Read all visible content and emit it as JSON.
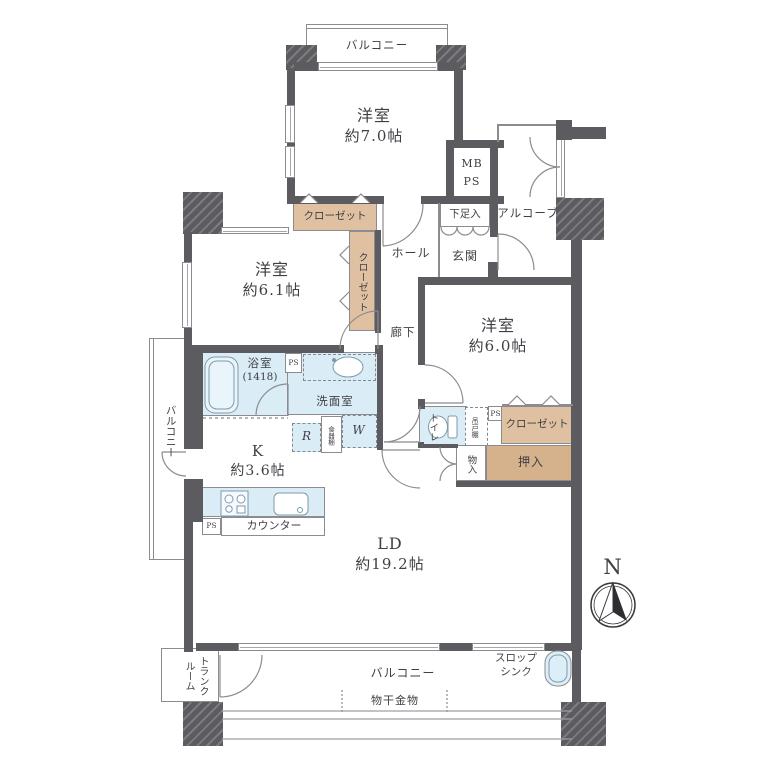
{
  "plan": {
    "rooms": {
      "bedroom_7": {
        "name": "洋室",
        "size": "約7.0帖"
      },
      "bedroom_61": {
        "name": "洋室",
        "size": "約6.1帖"
      },
      "bedroom_60": {
        "name": "洋室",
        "size": "約6.0帖"
      },
      "living_dining": {
        "name": "LD",
        "size": "約19.2帖"
      },
      "kitchen": {
        "name": "K",
        "size": "約3.6帖"
      },
      "bathroom": {
        "name": "浴室",
        "size": "(1418)"
      },
      "washroom": "洗面室",
      "toilet": "トイレ",
      "hall": "ホール",
      "corridor": "廊下",
      "entrance": "玄関",
      "alcove": "アルコーブ",
      "shoe_cabinet": "下足入"
    },
    "storage": {
      "closet": "クローゼット",
      "oshiire": "押入",
      "storage_small": "物入",
      "hanging_cupboard": "吊戸棚",
      "dish_shelf": "食器棚"
    },
    "outdoor": {
      "balcony": "バルコニー",
      "trunk_room_line1": "トランク",
      "trunk_room_line2": "ルーム",
      "slop_sink_line1": "スロップ",
      "slop_sink_line2": "シンク",
      "laundry_hardware": "物干金物"
    },
    "fixtures": {
      "mb": "MB",
      "ps": "PS",
      "refrigerator": "R",
      "washer": "W",
      "counter": "カウンター"
    },
    "compass": {
      "north": "N"
    },
    "colors": {
      "wall": "#5b5b60",
      "wet_area": "#daecf6",
      "closet_tan": "#dfc0a1",
      "oshiire_tan": "#d5b28c",
      "line": "#8b8b90",
      "text": "#3f3f45"
    }
  }
}
